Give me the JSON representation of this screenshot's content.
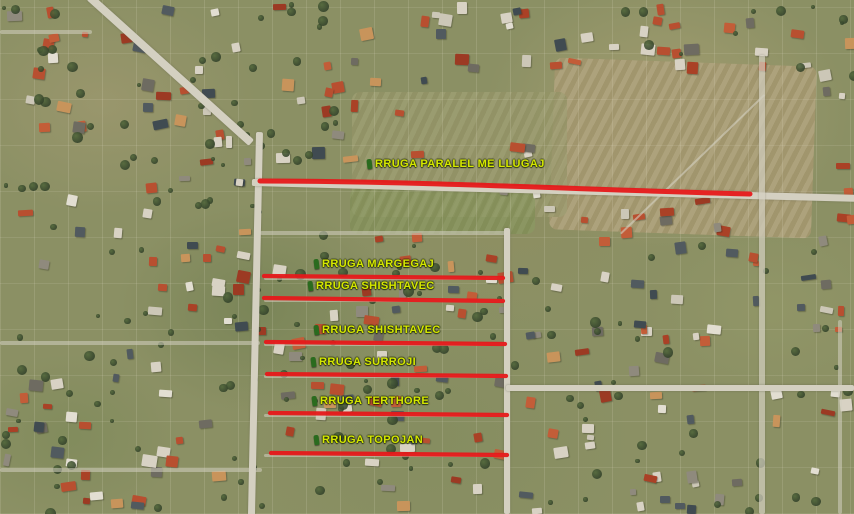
{
  "map": {
    "type": "satellite-annotated-streets",
    "colors": {
      "highlight_red": "#e6191a",
      "label_yellow": "#d5e800",
      "marker_green": "#2a6b1e"
    },
    "streets": [
      {
        "label": "RRUGA PARALEL ME LLUGAJ",
        "label_x": 367,
        "label_y": 158,
        "x1": 260,
        "y1": 181,
        "x2": 750,
        "y2": 194,
        "curved": true,
        "thickness": 5
      },
      {
        "label": "RRUGA MARGEGAJ",
        "label_x": 314,
        "label_y": 258,
        "x1": 264,
        "y1": 276,
        "x2": 503,
        "y2": 278,
        "curved": false,
        "thickness": 4.3
      },
      {
        "label": "RRUGA SHISHTAVEC",
        "label_x": 308,
        "label_y": 280,
        "x1": 264,
        "y1": 298,
        "x2": 503,
        "y2": 301,
        "curved": false,
        "thickness": 4.3
      },
      {
        "label": "RRUGA SHISHTAVEC",
        "label_x": 314,
        "label_y": 324,
        "x1": 266,
        "y1": 342,
        "x2": 505,
        "y2": 344,
        "curved": false,
        "thickness": 4.3
      },
      {
        "label": "RRUGA SURROJI",
        "label_x": 311,
        "label_y": 356,
        "x1": 267,
        "y1": 374,
        "x2": 506,
        "y2": 376,
        "curved": false,
        "thickness": 4.3
      },
      {
        "label": "RRUGA TERTHORE",
        "label_x": 312,
        "label_y": 395,
        "x1": 270,
        "y1": 413,
        "x2": 507,
        "y2": 415,
        "curved": false,
        "thickness": 4.3
      },
      {
        "label": "RRUGA TOPOJAN",
        "label_x": 314,
        "label_y": 434,
        "x1": 271,
        "y1": 453,
        "x2": 507,
        "y2": 455,
        "curved": false,
        "thickness": 4.3
      }
    ]
  }
}
